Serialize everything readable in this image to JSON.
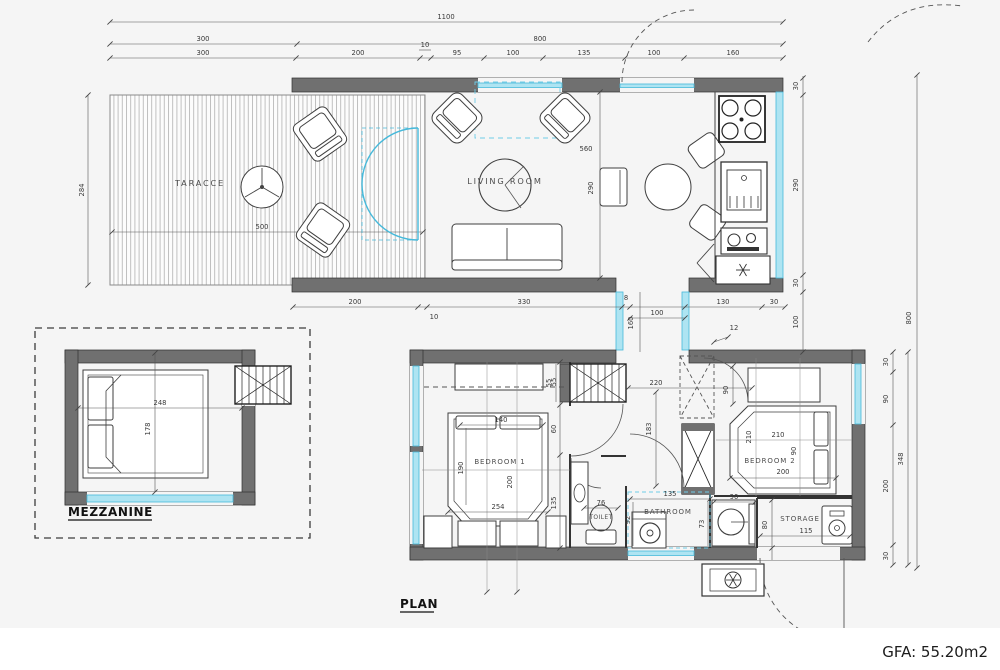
{
  "page": {
    "plan_label": "PLAN",
    "gfa_label": "GFA: 55.20m2"
  },
  "colors": {
    "wall": "#707070",
    "glass": "#5ec8e5",
    "dimension_line": "#555555",
    "background": "#f5f5f5",
    "text": "#3b3b3b"
  },
  "rooms": {
    "terrace": "TARACCE",
    "living_room": "LIVING ROOM",
    "bedroom1": "BEDROOM 1",
    "bedroom2": "BEDROOM 2",
    "toilet": "TOILET",
    "bathroom": "BATHROOM",
    "storage": "STORAGE",
    "mezzanine": "MEZZANINE"
  },
  "dims": {
    "total_width": "1100",
    "top_row2": [
      "300",
      "800"
    ],
    "top_row3": [
      "300",
      "200",
      "10",
      "95",
      "100",
      "135",
      "100",
      "160"
    ],
    "terrace_height": "284",
    "terrace_width": "500",
    "living_w": "560",
    "living_h": "290",
    "kitchen_chain": [
      "30",
      "290",
      "30"
    ],
    "bottom_chain": [
      "200",
      "10",
      "330",
      "8",
      "130",
      "30"
    ],
    "corridor_w": "100",
    "corridor_h": "160",
    "corridor_right": "100",
    "corridor_note": "12",
    "stairs_w": "55",
    "stairs_len": "220",
    "b1_chain": [
      "55",
      "60",
      "135"
    ],
    "bed1_w": "140",
    "bed1_side": "190",
    "bed1_len": "200",
    "bed1_base": "254",
    "hall_h": "183",
    "toilet_w": "76",
    "bath_w": "135",
    "bath_h": "92",
    "vanity_w": "90",
    "vanity_h": "73",
    "bed2_top": "90",
    "bed2_side": "210",
    "bed2_w": "210",
    "bed2_mid": "90",
    "bed2_base": "200",
    "storage_w": "115",
    "storage_h": "80",
    "right_chain": [
      "30",
      "90",
      "200",
      "30"
    ],
    "right_total": "348",
    "site_height": "800",
    "mezz_w": "248",
    "mezz_h": "178"
  }
}
